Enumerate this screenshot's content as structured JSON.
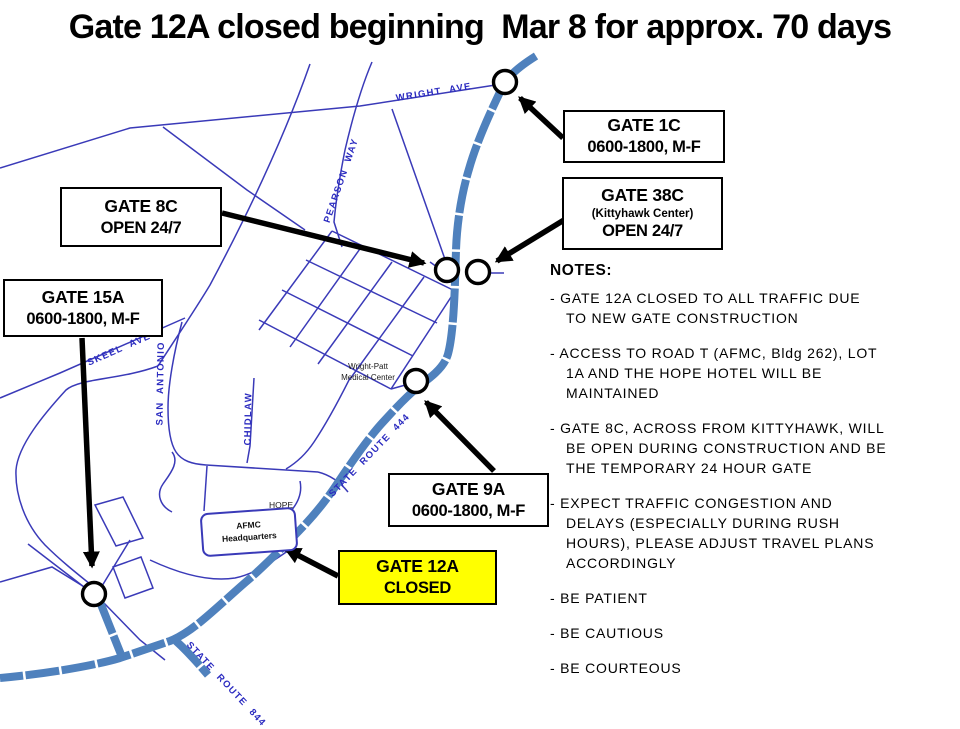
{
  "title": "Gate 12A closed beginning  Mar 8 for approx. 70 days",
  "colors": {
    "background": "#ffffff",
    "highway_road": "#4f81bd",
    "street_road": "#3a3ab8",
    "road_label_text": "#2b2bc0",
    "closed_gate_box_bg": "#ffff00",
    "arrow_and_marker": "#000000"
  },
  "gates": {
    "g8c": {
      "name": "GATE 8C",
      "schedule": "OPEN 24/7"
    },
    "g15a": {
      "name": "GATE 15A",
      "schedule": "0600-1800, M-F"
    },
    "g1c": {
      "name": "GATE 1C",
      "schedule": "0600-1800, M-F"
    },
    "g38c": {
      "name": "GATE 38C",
      "subtitle": "(Kittyhawk Center)",
      "schedule": "OPEN 24/7"
    },
    "g9a": {
      "name": "GATE 9A",
      "schedule": "0600-1800, M-F"
    },
    "g12a": {
      "name": "GATE 12A",
      "schedule": "CLOSED"
    }
  },
  "map_labels": {
    "wright_ave": "WRIGHT AVE",
    "pearson_way": "PEARSON WAY",
    "skeel_ave": "SKEEL AVE",
    "san_antonio": "SAN ANTONIO",
    "chidlaw": "CHIDLAW",
    "state_route_444": "STATE ROUTE 444",
    "state_route_844": "STATE ROUTE 844",
    "medical_center_line1": "Wright-Patt",
    "medical_center_line2": "Medical Center",
    "hope_hotel_line1": "HOPE",
    "hope_hotel_line2": "HOTEL",
    "afmc_line1": "AFMC",
    "afmc_line2": "Headquarters"
  },
  "notes": {
    "heading": "NOTES:",
    "items": [
      "- GATE 12A CLOSED TO ALL TRAFFIC DUE\nTO NEW GATE CONSTRUCTION",
      "- ACCESS TO ROAD T (AFMC, Bldg 262), LOT\n1A AND THE HOPE HOTEL WILL BE\nMAINTAINED",
      "- GATE 8C, ACROSS FROM KITTYHAWK, WILL\nBE OPEN DURING CONSTRUCTION AND BE\nTHE TEMPORARY  24 HOUR GATE",
      "- EXPECT TRAFFIC CONGESTION AND\nDELAYS (ESPECIALLY DURING RUSH\nHOURS), PLEASE ADJUST TRAVEL PLANS\nACCORDINGLY",
      "- BE PATIENT",
      "- BE CAUTIOUS",
      "- BE COURTEOUS"
    ]
  }
}
